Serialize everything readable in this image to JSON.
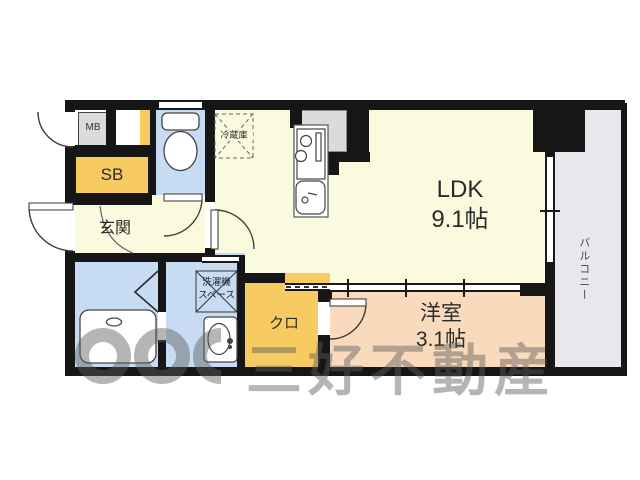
{
  "rooms": {
    "ldk": {
      "name": "LDK",
      "size": "9.1帖"
    },
    "western": {
      "name": "洋室",
      "size": "3.1帖"
    },
    "entrance": {
      "name": "玄関"
    },
    "closet": {
      "name": "クロ"
    },
    "balcony": {
      "name": "バルコニー"
    },
    "shoe_box": {
      "name": "SB"
    },
    "meter_box": {
      "name": "MB"
    }
  },
  "annotations": {
    "refrigerator": {
      "name": "冷蔵庫"
    },
    "washer_space": {
      "line1": "洗濯機",
      "line2": "スペース"
    }
  },
  "watermark": {
    "text": "三好不動産"
  },
  "colors": {
    "wall": "#161616",
    "room_main": "#FAFADF",
    "room_wet": "#C7DCF2",
    "room_western": "#F9DABD",
    "room_storage": "#F7CB62",
    "balcony": "#E9E7EC",
    "fixture_gray": "#DBDBDB",
    "watermark": "rgba(92,92,92,0.45)"
  }
}
